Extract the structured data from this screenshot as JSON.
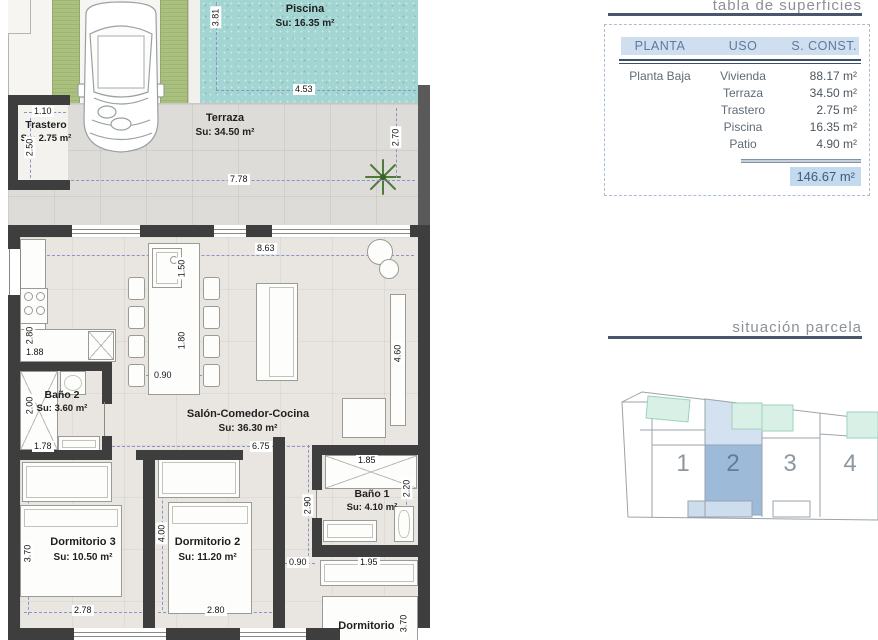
{
  "titles": {
    "table_section": "tabla de superficies",
    "parcela_section": "situación parcela"
  },
  "surfaces_table": {
    "headers": {
      "planta": "PLANTA",
      "uso": "USO",
      "sconst": "S. CONST."
    },
    "planta": "Planta Baja",
    "rows": [
      {
        "uso": "Vivienda",
        "sconst": "88.17 m²"
      },
      {
        "uso": "Terraza",
        "sconst": "34.50 m²"
      },
      {
        "uso": "Trastero",
        "sconst": "2.75 m²"
      },
      {
        "uso": "Piscina",
        "sconst": "16.35 m²"
      },
      {
        "uso": "Patio",
        "sconst": "4.90 m²"
      }
    ],
    "total": "146.67 m²"
  },
  "floorplan": {
    "rooms": {
      "piscina": {
        "name": "Piscina",
        "su": "Su: 16.35 m²"
      },
      "terraza": {
        "name": "Terraza",
        "su": "Su: 34.50 m²"
      },
      "trastero": {
        "name": "Trastero",
        "su": "Su: 2.75 m²"
      },
      "salon": {
        "name": "Salón-Comedor-Cocina",
        "su": "Su: 36.30 m²"
      },
      "bano2": {
        "name": "Baño 2",
        "su": "Su: 3.60 m²"
      },
      "bano1": {
        "name": "Baño 1",
        "su": "Su: 4.10 m²"
      },
      "dormitorio3": {
        "name": "Dormitorio 3",
        "su": "Su: 10.50 m²"
      },
      "dormitorio2": {
        "name": "Dormitorio 2",
        "su": "Su: 11.20 m²"
      },
      "dormitorio1": {
        "name": "Dormitorio 1"
      }
    },
    "dimensions": {
      "pool_h": "3.81",
      "pool_w": "4.53",
      "trastero_w": "1.10",
      "trastero_h": "2.50",
      "terraza_w": "7.78",
      "terraza_h": "2.70",
      "salon_top": "8.63",
      "island_h1": "1.50",
      "island_h2": "1.80",
      "island_w": "0.90",
      "kitchen_h": "2.80",
      "kitchen_w": "1.88",
      "bano2_h": "2.00",
      "bano2_w": "1.78",
      "salon_w": "6.75",
      "salon_h": "4.60",
      "dorm3_h": "3.70",
      "dorm3_w": "2.78",
      "dorm2_h": "4.00",
      "dorm2_w": "2.80",
      "bano1_w": "1.85",
      "bano1_h": "2.20",
      "hall_h": "2.90",
      "hall_w": "0.90",
      "wardrobe_w": "1.95",
      "dorm1_h": "3.70"
    }
  },
  "parcela": {
    "plots": [
      "1",
      "2",
      "3",
      "4"
    ],
    "highlighted_plot": "2"
  },
  "colors": {
    "wall": "#3e3e3e",
    "pool_teal": "#a3d6d2",
    "grass_green": "#a9c07e",
    "terraza_gray": "#dedcd8",
    "floor_beige": "#e9e6e1",
    "table_header_bg": "#cfdfef",
    "table_header_text": "#5c7a9b",
    "total_bg": "#c2d9ee",
    "rule_dark": "#47566b",
    "plot_highlight": "#9dbbd9",
    "plot_highlight_light": "#d4e1f0"
  }
}
